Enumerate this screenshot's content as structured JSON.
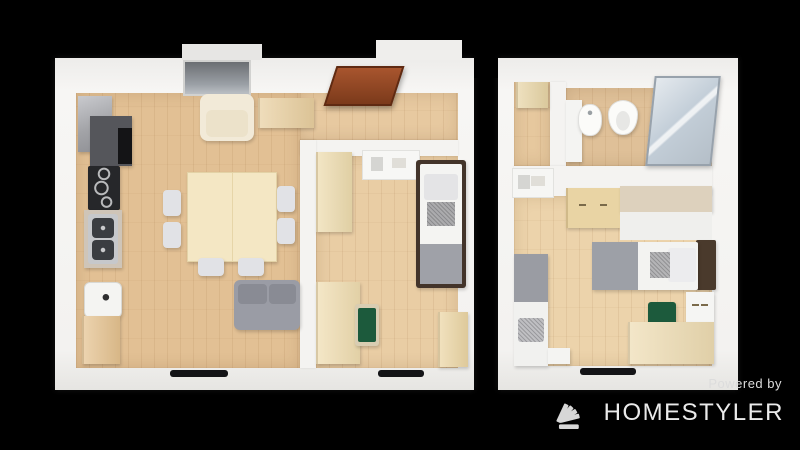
{
  "canvas": {
    "width": 800,
    "height": 450,
    "background": "#000000"
  },
  "watermark": {
    "powered_by": "Powered by",
    "brand": "HOMESTYLER",
    "text_color": "#e2e2e2",
    "logo_icon": "homestyler-fan-logo",
    "logo_color": "#d7d7d7"
  },
  "palette": {
    "background": "#000000",
    "wall_white": "#f3f2f0",
    "floor_wood": "#e5c79d",
    "furniture_wood": "#ecd6a4",
    "sofa_gray": "#9a9ca5",
    "chair_green": "#1c5a3c",
    "door_brown": "#9a4a27",
    "appliance_dark": "#55565b",
    "shower_glass": "#c4cfd9"
  },
  "plan": {
    "order": [
      "slabs",
      "floors",
      "walls",
      "furniture",
      "overlays"
    ],
    "slabs": [
      {
        "name": "unit1-wall-slab",
        "x": 55,
        "y": 58,
        "w": 419,
        "h": 332,
        "cls": "slab"
      },
      {
        "name": "unit2-wall-slab",
        "x": 498,
        "y": 58,
        "w": 240,
        "h": 332,
        "cls": "slab"
      },
      {
        "name": "balcony-door-top-block",
        "x": 182,
        "y": 44,
        "w": 80,
        "h": 16,
        "color": "#e7e6e4"
      },
      {
        "name": "hall-closet-top-block",
        "x": 376,
        "y": 40,
        "w": 86,
        "h": 20,
        "color": "#efeeec"
      },
      {
        "name": "unit-gap-notch",
        "x": 474,
        "y": 58,
        "w": 24,
        "h": 20,
        "color": "#000000"
      }
    ],
    "floors": [
      {
        "name": "living-kitchen-floor",
        "x": 76,
        "y": 93,
        "w": 224,
        "h": 275,
        "color": "#e2c094"
      },
      {
        "name": "unit1-hallway-floor",
        "x": 300,
        "y": 93,
        "w": 158,
        "h": 47,
        "color": "#e7c9a0"
      },
      {
        "name": "bedroom1-floor",
        "x": 316,
        "y": 156,
        "w": 142,
        "h": 212,
        "color": "#e9cda4"
      },
      {
        "name": "unit2-hall-floor",
        "x": 514,
        "y": 82,
        "w": 36,
        "h": 84,
        "color": "#e6c89e"
      },
      {
        "name": "bathroom-floor",
        "x": 566,
        "y": 88,
        "w": 146,
        "h": 78,
        "color": "#dfc098"
      },
      {
        "name": "bedroom2-floor",
        "x": 514,
        "y": 196,
        "w": 198,
        "h": 170,
        "color": "#ecd3ab"
      }
    ],
    "walls": [
      {
        "name": "wall-hall-bedroom1",
        "x": 300,
        "y": 140,
        "w": 158,
        "h": 16,
        "color": "#f4f3f1",
        "cls": "wallpiece"
      },
      {
        "name": "wall-living-bedroom1",
        "x": 300,
        "y": 140,
        "w": 16,
        "h": 228,
        "color": "#f4f3f1",
        "cls": "wallpiece"
      },
      {
        "name": "wall-hall2-bathroom",
        "x": 550,
        "y": 82,
        "w": 16,
        "h": 84,
        "color": "#f4f3f1",
        "cls": "wallpiece"
      },
      {
        "name": "wall-bathroom-bedroom2",
        "x": 514,
        "y": 166,
        "w": 198,
        "h": 30,
        "color": "#f4f3f1",
        "cls": "wallpiece"
      }
    ],
    "furniture": [
      {
        "name": "fridge",
        "x": 78,
        "y": 96,
        "w": 34,
        "h": 56,
        "color": "#a6a7ab",
        "cls": "fridge furn"
      },
      {
        "name": "kitchen-counter-dark",
        "x": 90,
        "y": 116,
        "w": 42,
        "h": 50,
        "color": "#55565b",
        "cls": "furn"
      },
      {
        "name": "oven",
        "x": 118,
        "y": 128,
        "w": 14,
        "h": 36,
        "color": "#141416"
      },
      {
        "name": "cooktop",
        "x": 88,
        "y": 166,
        "w": 32,
        "h": 44,
        "color": "#26272a",
        "cls": "cooktop furn"
      },
      {
        "name": "sink-counter",
        "x": 84,
        "y": 210,
        "w": 38,
        "h": 58,
        "color": "#cfc5b8",
        "cls": "furn"
      },
      {
        "name": "sink-body",
        "x": 88,
        "y": 214,
        "w": 30,
        "h": 50,
        "color": "#c6c8cb",
        "r": 3
      },
      {
        "name": "sink-basin-top",
        "x": 92,
        "y": 218,
        "w": 22,
        "h": 20,
        "color": "#3a3d41",
        "r": 4,
        "cls": "basin"
      },
      {
        "name": "sink-basin-bottom",
        "x": 92,
        "y": 240,
        "w": 22,
        "h": 20,
        "color": "#3a3d41",
        "r": 4,
        "cls": "basin"
      },
      {
        "name": "washing-machine",
        "x": 84,
        "y": 282,
        "w": 36,
        "h": 34,
        "color": "#f4f4f2",
        "r": 6,
        "cls": "washer furn"
      },
      {
        "name": "kitchen-wood-cabinet",
        "x": 82,
        "y": 316,
        "w": 38,
        "h": 48,
        "color": "#e5c28f",
        "cls": "wood"
      },
      {
        "name": "balcony-glass-door",
        "x": 183,
        "y": 60,
        "w": 64,
        "h": 32,
        "color": "#8f9196",
        "cls": "glasspanel"
      },
      {
        "name": "armchair",
        "x": 200,
        "y": 94,
        "w": 54,
        "h": 47,
        "color": "#f2ead8",
        "r": 8,
        "cls": "armchair furn"
      },
      {
        "name": "console-table",
        "x": 258,
        "y": 98,
        "w": 56,
        "h": 30,
        "color": "#e9cf9f",
        "cls": "wood"
      },
      {
        "name": "entry-door-unit1",
        "x": 330,
        "y": 66,
        "w": 64,
        "h": 36,
        "color": "#9a4a27",
        "skew": -18,
        "cls": "door"
      },
      {
        "name": "dining-table",
        "x": 187,
        "y": 172,
        "w": 88,
        "h": 88,
        "color": "#f4e7c4",
        "cls": "table furn"
      },
      {
        "name": "dining-chair-left-1",
        "x": 163,
        "y": 190,
        "w": 18,
        "h": 26,
        "color": "#e1e2e6",
        "r": 4,
        "cls": "furn"
      },
      {
        "name": "dining-chair-left-2",
        "x": 163,
        "y": 222,
        "w": 18,
        "h": 26,
        "color": "#e1e2e6",
        "r": 4,
        "cls": "furn"
      },
      {
        "name": "dining-chair-right-1",
        "x": 277,
        "y": 186,
        "w": 18,
        "h": 26,
        "color": "#e1e2e6",
        "r": 4,
        "cls": "furn"
      },
      {
        "name": "dining-chair-right-2",
        "x": 277,
        "y": 218,
        "w": 18,
        "h": 26,
        "color": "#e1e2e6",
        "r": 4,
        "cls": "furn"
      },
      {
        "name": "dining-chair-bottom-1",
        "x": 198,
        "y": 258,
        "w": 26,
        "h": 18,
        "color": "#e1e2e6",
        "r": 4,
        "cls": "furn"
      },
      {
        "name": "dining-chair-bottom-2",
        "x": 238,
        "y": 258,
        "w": 26,
        "h": 18,
        "color": "#e1e2e6",
        "r": 4,
        "cls": "furn"
      },
      {
        "name": "sofa",
        "x": 234,
        "y": 280,
        "w": 66,
        "h": 50,
        "color": "#9a9ca5",
        "r": 6,
        "cls": "furn"
      },
      {
        "name": "sofa-cushion-left",
        "x": 238,
        "y": 284,
        "w": 29,
        "h": 20,
        "color": "#898b94",
        "r": 4
      },
      {
        "name": "sofa-cushion-right",
        "x": 269,
        "y": 284,
        "w": 27,
        "h": 20,
        "color": "#898b94",
        "r": 4
      },
      {
        "name": "bedroom1-wardrobe",
        "x": 316,
        "y": 152,
        "w": 36,
        "h": 80,
        "color": "#eedcae",
        "cls": "wood"
      },
      {
        "name": "bedroom1-wall-shelf",
        "x": 362,
        "y": 150,
        "w": 56,
        "h": 28,
        "color": "#f7f7f5",
        "cls": "shelfart"
      },
      {
        "name": "bed1-frame",
        "x": 416,
        "y": 160,
        "w": 50,
        "h": 128,
        "color": "#43342a",
        "r": 3,
        "cls": "furn"
      },
      {
        "name": "bed1-mattress",
        "x": 420,
        "y": 164,
        "w": 42,
        "h": 120,
        "color": "#f4f4f2",
        "r": 2
      },
      {
        "name": "bed1-blanket",
        "x": 420,
        "y": 244,
        "w": 42,
        "h": 40,
        "color": "#9fa1a8"
      },
      {
        "name": "bed1-pillow",
        "x": 424,
        "y": 174,
        "w": 34,
        "h": 26,
        "color": "#e4e4e6",
        "r": 3
      },
      {
        "name": "bed1-cushion",
        "x": 427,
        "y": 202,
        "w": 28,
        "h": 24,
        "color": "#ababad",
        "cls": "speckle"
      },
      {
        "name": "bedroom1-desk",
        "x": 316,
        "y": 282,
        "w": 44,
        "h": 82,
        "color": "#f0ddb0",
        "cls": "wood"
      },
      {
        "name": "bedroom1-chair-frame",
        "x": 355,
        "y": 304,
        "w": 24,
        "h": 42,
        "color": "#d9cdb2",
        "r": 3,
        "cls": "furn"
      },
      {
        "name": "bedroom1-chair-green",
        "x": 358,
        "y": 308,
        "w": 18,
        "h": 34,
        "color": "#1c5a3c",
        "r": 2
      },
      {
        "name": "bedroom1-cabinet",
        "x": 438,
        "y": 312,
        "w": 30,
        "h": 55,
        "color": "#ecd6a4",
        "cls": "wood"
      },
      {
        "name": "unit2-hall-cabinet",
        "x": 516,
        "y": 82,
        "w": 32,
        "h": 26,
        "color": "#e8d5a6",
        "cls": "wood"
      },
      {
        "name": "bathroom-vanity",
        "x": 566,
        "y": 100,
        "w": 16,
        "h": 62,
        "color": "#f4f4f2",
        "cls": "furn"
      },
      {
        "name": "bidet",
        "x": 578,
        "y": 104,
        "w": 22,
        "h": 30,
        "color": "#fbfbf9",
        "cls": "oval furn"
      },
      {
        "name": "toilet",
        "x": 608,
        "y": 100,
        "w": 28,
        "h": 33,
        "color": "#fbfbf9",
        "cls": "toilet furn"
      },
      {
        "name": "shower-enclosure",
        "x": 650,
        "y": 76,
        "w": 62,
        "h": 86,
        "color": "#c4cfd9",
        "skew": -6,
        "cls": "shower"
      },
      {
        "name": "bedroom2-wall-shelf",
        "x": 512,
        "y": 168,
        "w": 40,
        "h": 28,
        "color": "#f6f6f4",
        "cls": "shelfart"
      },
      {
        "name": "bedroom2-dresser",
        "x": 566,
        "y": 188,
        "w": 54,
        "h": 40,
        "color": "#e9d4a4",
        "cls": "handles wood"
      },
      {
        "name": "bedroom2-counter-top",
        "x": 620,
        "y": 186,
        "w": 92,
        "h": 26,
        "color": "#ddd1bd",
        "cls": "furn"
      },
      {
        "name": "bedroom2-counter-front",
        "x": 620,
        "y": 212,
        "w": 92,
        "h": 28,
        "color": "#efefed"
      },
      {
        "name": "bed2-vertical-base",
        "x": 514,
        "y": 254,
        "w": 34,
        "h": 112,
        "color": "#f1f1ef",
        "cls": "furn"
      },
      {
        "name": "bed2-vertical-blanket",
        "x": 514,
        "y": 254,
        "w": 34,
        "h": 48,
        "color": "#9a9ca3"
      },
      {
        "name": "bed2-vertical-pillow",
        "x": 518,
        "y": 318,
        "w": 26,
        "h": 24,
        "color": "#bfbfc2",
        "r": 3,
        "cls": "speckle"
      },
      {
        "name": "bed2-vertical-nightstand",
        "x": 548,
        "y": 348,
        "w": 22,
        "h": 16,
        "color": "#f4f4f2",
        "cls": "furn"
      },
      {
        "name": "bed2-horizontal-headboard",
        "x": 696,
        "y": 240,
        "w": 20,
        "h": 50,
        "color": "#4a3a2c",
        "r": 2,
        "cls": "furn"
      },
      {
        "name": "bed2-horizontal-base",
        "x": 592,
        "y": 242,
        "w": 106,
        "h": 48,
        "color": "#f3f3f1",
        "r": 2,
        "cls": "furn"
      },
      {
        "name": "bed2-horizontal-blanket",
        "x": 592,
        "y": 242,
        "w": 46,
        "h": 48,
        "color": "#9da0a7"
      },
      {
        "name": "bed2-horizontal-pillow",
        "x": 668,
        "y": 248,
        "w": 28,
        "h": 34,
        "color": "#ececee",
        "r": 3
      },
      {
        "name": "bed2-horizontal-cushion",
        "x": 650,
        "y": 252,
        "w": 20,
        "h": 26,
        "color": "#b4b4b6",
        "cls": "speckle"
      },
      {
        "name": "bedroom2-nightstand",
        "x": 686,
        "y": 292,
        "w": 28,
        "h": 30,
        "color": "#f5f5f3",
        "cls": "handles furn"
      },
      {
        "name": "bedroom2-chair-green",
        "x": 648,
        "y": 302,
        "w": 28,
        "h": 24,
        "color": "#1c5a3c",
        "r": 3,
        "cls": "furn"
      },
      {
        "name": "bedroom2-desk",
        "x": 628,
        "y": 322,
        "w": 86,
        "h": 42,
        "color": "#eedcb2",
        "cls": "wood"
      }
    ],
    "overlays": [
      {
        "name": "window-living-bottom",
        "x": 170,
        "y": 370,
        "w": 58,
        "h": 7,
        "color": "#141417",
        "r": 3
      },
      {
        "name": "window-bedroom1-bottom",
        "x": 378,
        "y": 370,
        "w": 46,
        "h": 7,
        "color": "#141417",
        "r": 3
      },
      {
        "name": "window-bedroom2-bottom",
        "x": 580,
        "y": 368,
        "w": 56,
        "h": 7,
        "color": "#141417",
        "r": 3
      }
    ]
  }
}
